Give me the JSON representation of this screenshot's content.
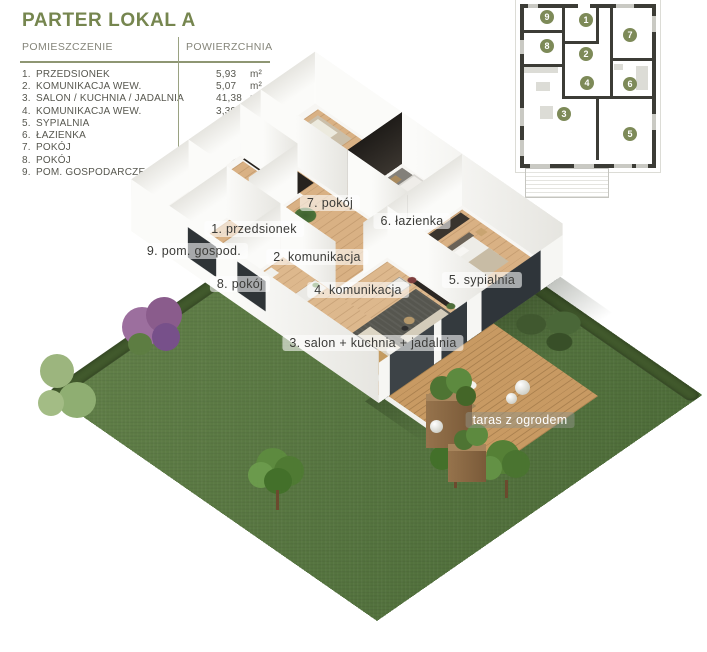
{
  "panel": {
    "title": "PARTER LOKAL A",
    "columns": {
      "room": "POMIESZCZENIE",
      "area": "POWIERZCHNIA"
    },
    "rows": [
      {
        "no": "1.",
        "name": "PRZEDSIONEK",
        "area": "5,93",
        "unit": "m²"
      },
      {
        "no": "2.",
        "name": "KOMUNIKACJA WEW.",
        "area": "5,07",
        "unit": "m²"
      },
      {
        "no": "3.",
        "name": "SALON / KUCHNIA / JADALNIA",
        "area": "41,38",
        "unit": "m²"
      },
      {
        "no": "4.",
        "name": "KOMUNIKACJA WEW.",
        "area": "3,39",
        "unit": "m²"
      },
      {
        "no": "5.",
        "name": "SYPIALNIA",
        "area": "15,00",
        "unit": "m²"
      },
      {
        "no": "6.",
        "name": "ŁAZIENKA",
        "area": "6,38",
        "unit": "m²"
      },
      {
        "no": "7.",
        "name": "POKÓJ",
        "area": "13,57",
        "unit": "m²"
      },
      {
        "no": "8.",
        "name": "POKÓJ",
        "area": "8,32",
        "unit": "m²"
      },
      {
        "no": "9.",
        "name": "POM. GOSPODARCZE",
        "area": "4,10",
        "unit": "m²"
      }
    ]
  },
  "miniplan": {
    "units": [
      "1",
      "2",
      "3",
      "4",
      "5",
      "6",
      "7",
      "8",
      "9"
    ]
  },
  "plan_labels": {
    "l1": "1. przedsionek",
    "l2": "2. komunikacja",
    "l3": "3. salon + kuchnia + jadalnia",
    "l4": "4. komunikacja",
    "l5": "5. sypialnia",
    "l6": "6. łazienka",
    "l7": "7. pokój",
    "l8": "8. pokój",
    "l9": "9. pom. gospod.",
    "terrace": "taras z ogrodem"
  },
  "colors": {
    "accent_green": "#76864f",
    "circle_green": "#7d8a58",
    "grass": "#5a7a42",
    "hedge": "#41592c",
    "wood_floor": "#d9b184",
    "deck_wood": "#c89a63",
    "wall_white": "#f7f6f3",
    "bath_dark": "#2a2622"
  }
}
